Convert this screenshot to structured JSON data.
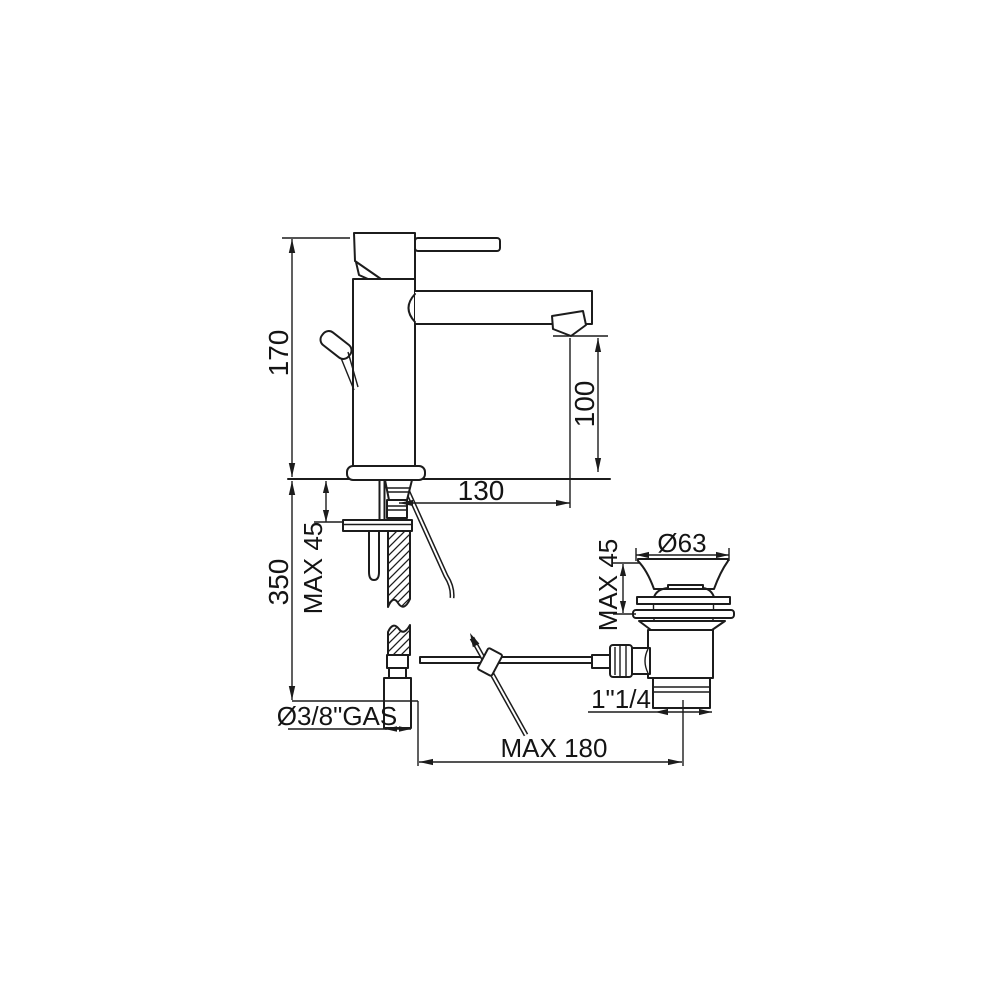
{
  "drawing": {
    "labels": {
      "overall_height": "170",
      "spout_height": "100",
      "spout_reach": "130",
      "under_deck_height": "350",
      "deck_max_left": "MAX 45",
      "supply_connection": "Ø3/8\"GAS",
      "waste_flange_diameter": "Ø63",
      "waste_deck_max": "MAX 45",
      "waste_thread": "1\"1/4",
      "rod_reach_max": "MAX 180"
    }
  }
}
